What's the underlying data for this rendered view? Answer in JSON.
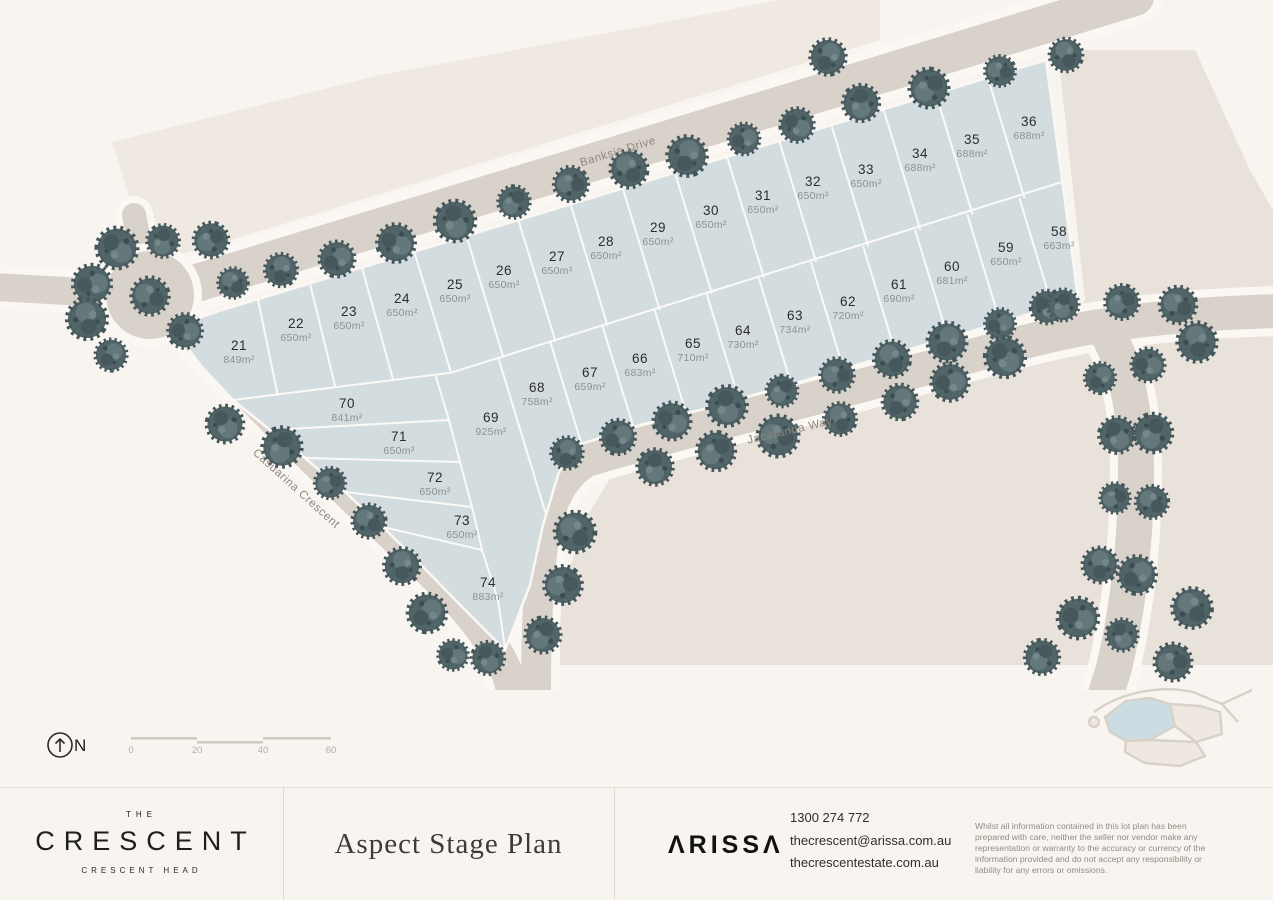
{
  "map": {
    "compass_label": "N",
    "scale_ticks": [
      "0",
      "20",
      "40",
      "60"
    ],
    "roads": [
      {
        "name": "Banksia Drive"
      },
      {
        "name": "Jacaranda Way"
      },
      {
        "name": "Casuarina Crescent"
      }
    ],
    "lots": [
      {
        "number": "21",
        "area": "849m²"
      },
      {
        "number": "22",
        "area": "650m²"
      },
      {
        "number": "23",
        "area": "650m²"
      },
      {
        "number": "24",
        "area": "650m²"
      },
      {
        "number": "25",
        "area": "650m²"
      },
      {
        "number": "26",
        "area": "650m²"
      },
      {
        "number": "27",
        "area": "650m²"
      },
      {
        "number": "28",
        "area": "650m²"
      },
      {
        "number": "29",
        "area": "650m²"
      },
      {
        "number": "30",
        "area": "650m²"
      },
      {
        "number": "31",
        "area": "650m²"
      },
      {
        "number": "32",
        "area": "650m²"
      },
      {
        "number": "33",
        "area": "650m²"
      },
      {
        "number": "34",
        "area": "688m²"
      },
      {
        "number": "35",
        "area": "688m²"
      },
      {
        "number": "36",
        "area": "688m²"
      },
      {
        "number": "58",
        "area": "663m²"
      },
      {
        "number": "59",
        "area": "650m²"
      },
      {
        "number": "60",
        "area": "681m²"
      },
      {
        "number": "61",
        "area": "690m²"
      },
      {
        "number": "62",
        "area": "720m²"
      },
      {
        "number": "63",
        "area": "734m²"
      },
      {
        "number": "64",
        "area": "730m²"
      },
      {
        "number": "65",
        "area": "710m²"
      },
      {
        "number": "66",
        "area": "683m²"
      },
      {
        "number": "67",
        "area": "659m²"
      },
      {
        "number": "68",
        "area": "758m²"
      },
      {
        "number": "69",
        "area": "925m²"
      },
      {
        "number": "70",
        "area": "841m²"
      },
      {
        "number": "71",
        "area": "650m²"
      },
      {
        "number": "72",
        "area": "650m²"
      },
      {
        "number": "73",
        "area": "650m²"
      },
      {
        "number": "74",
        "area": "883m²"
      }
    ]
  },
  "footer": {
    "brand": {
      "pre": "THE",
      "name": "CRESCENT",
      "location": "CRESCENT HEAD"
    },
    "plan_title": "Aspect Stage Plan",
    "agency_logo": "ΛRISSΛ",
    "phone": "1300 274 772",
    "email": "thecrescent@arissa.com.au",
    "website": "thecrescentestate.com.au",
    "disclaimer": "Whilst all information contained in this lot plan has been prepared with care, neither the seller nor vendor make any representation or warranty to the accuracy or currency of the information provided and do not accept any responsibility or liability for any errors or omissions."
  },
  "colors": {
    "background": "#f8f4ef",
    "lot_fill": "#d3dcdf",
    "road_fill": "#d9d2ca",
    "road_casing": "#fbf8f3",
    "pale_area": "#efe9e2",
    "beige_area": "#e9e2da",
    "tree": "#516569",
    "inset_highlight": "#cbdde2"
  }
}
